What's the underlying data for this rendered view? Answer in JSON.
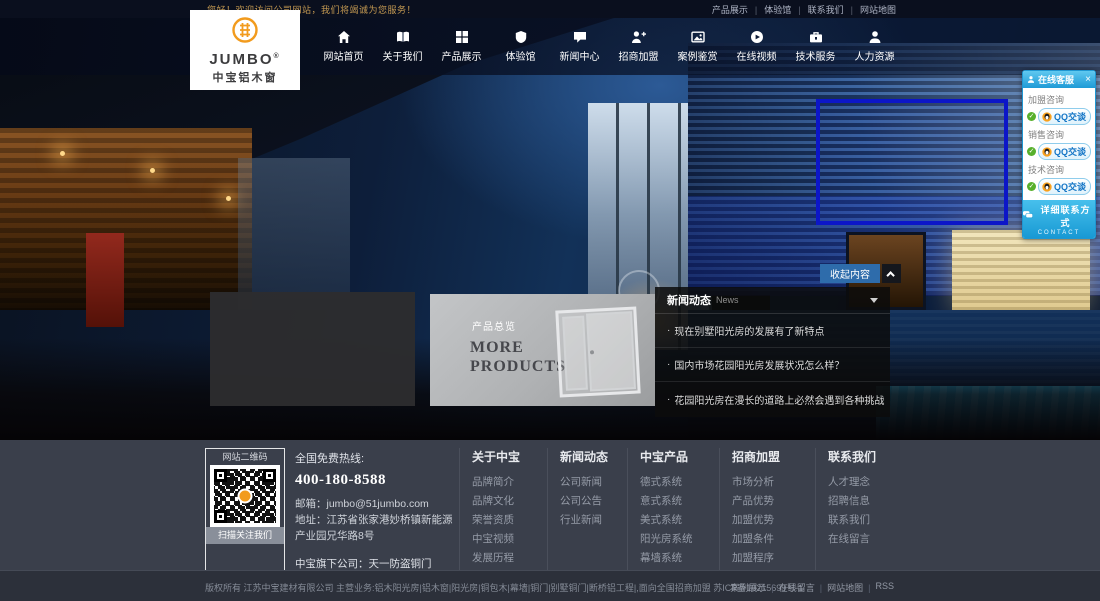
{
  "topbar": {
    "welcome": "您好！欢迎访问公司网站，我们将竭诚为您服务！",
    "links": [
      "产品展示",
      "体验馆",
      "联系我们",
      "网站地图"
    ]
  },
  "header": {
    "logo": {
      "brand": "JUMBO",
      "reg": "®",
      "subtitle": "中宝铝木窗"
    },
    "nav": [
      {
        "label": "网站首页",
        "icon": "home-icon"
      },
      {
        "label": "关于我们",
        "icon": "book-icon"
      },
      {
        "label": "产品展示",
        "icon": "grid-icon"
      },
      {
        "label": "体验馆",
        "icon": "shield-icon"
      },
      {
        "label": "新闻中心",
        "icon": "chat-icon"
      },
      {
        "label": "招商加盟",
        "icon": "user-plus-icon"
      },
      {
        "label": "案例鉴赏",
        "icon": "photo-icon"
      },
      {
        "label": "在线视频",
        "icon": "video-icon"
      },
      {
        "label": "技术服务",
        "icon": "toolbox-icon"
      },
      {
        "label": "人力资源",
        "icon": "user-icon"
      }
    ]
  },
  "hero": {
    "collapse_button": "收起内容",
    "products_card": {
      "tag": "产品总览",
      "title": "MORE PRODUCTS"
    },
    "news": {
      "title": "新闻动态",
      "subtitle": "News",
      "items": [
        "现在别墅阳光房的发展有了新特点",
        "国内市场花园阳光房发展状况怎么样？",
        "花园阳光房在漫长的道路上必然会遇到各种挑战"
      ]
    }
  },
  "qq_panel": {
    "title": "在线客服",
    "close": "×",
    "groups": [
      {
        "label": "加盟咨询",
        "button": "QQ交谈"
      },
      {
        "label": "销售咨询",
        "button": "QQ交谈"
      },
      {
        "label": "技术咨询",
        "button": "QQ交谈"
      }
    ],
    "contact": "详细联系方式",
    "contact_sub": "CONTACT"
  },
  "footer": {
    "qr": {
      "title": "网站二维码",
      "caption": "扫描关注我们"
    },
    "contact": {
      "hotline_label": "全国免费热线:",
      "phone": "400-180-8588",
      "email_label": "邮箱：",
      "email": "jumbo@51jumbo.com",
      "address_label": "地址：",
      "address": "江苏省张家港妙桥镇新能源产业园兄华路8号",
      "subsidiary_label": "中宝旗下公司：",
      "subsidiary": "天一防盗铜门"
    },
    "columns": [
      {
        "title": "关于中宝",
        "links": [
          "品牌简介",
          "品牌文化",
          "荣誉资质",
          "中宝视频",
          "发展历程",
          "品牌形象"
        ]
      },
      {
        "title": "新闻动态",
        "links": [
          "公司新闻",
          "公司公告",
          "行业新闻"
        ]
      },
      {
        "title": "中宝产品",
        "links": [
          "德式系统",
          "意式系统",
          "美式系统",
          "阳光房系统",
          "幕墙系统",
          "断桥铝系统"
        ]
      },
      {
        "title": "招商加盟",
        "links": [
          "市场分析",
          "产品优势",
          "加盟优势",
          "加盟条件",
          "加盟程序",
          "加盟留言",
          "申请表下载"
        ]
      },
      {
        "title": "联系我们",
        "links": [
          "人才理念",
          "招聘信息",
          "联系我们",
          "在线留言"
        ]
      }
    ]
  },
  "copyright": {
    "text": "版权所有 江苏中宝建材有限公司 主营业务:铝木阳光房|铝木窗|阳光房|铜包木|幕墙|铜门|别墅铜门|断桥铝工程|,面向全国招商加盟 苏ICP备10215699号-1",
    "links": [
      "案例展示",
      "在线留言",
      "网站地图",
      "RSS"
    ]
  },
  "colors": {
    "brand_orange": "#f29b1d",
    "qq_blue": "#2aace2",
    "collapse_button_blue": "#2e6cab",
    "selection_outline_blue": "#0c16c8",
    "footer_bg": "#3a3f4b"
  }
}
